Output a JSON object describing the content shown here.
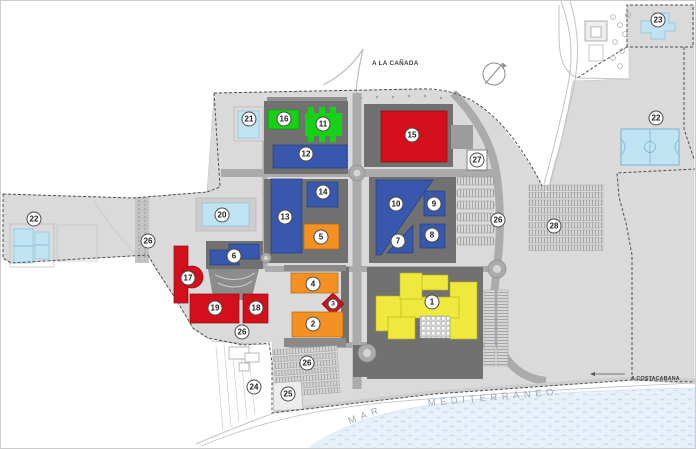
{
  "map": {
    "road_labels": {
      "north": "A LA CAÑADA",
      "east": "A COSTACABANA"
    },
    "sea_labels": {
      "word1": "MAR",
      "word2": "MEDITERRÁNEO"
    },
    "colors": {
      "red": "#d40f1c",
      "blue": "#3758ac",
      "green": "#16d116",
      "orange": "#f49122",
      "yellow": "#efe93e",
      "pool": "#bfe3f2",
      "land": "#dadada",
      "block": "#717171",
      "road": "#ababab",
      "sea": "#e8f1f9"
    },
    "markers": [
      {
        "n": "1",
        "x": 431,
        "y": 301,
        "cat": "yellow"
      },
      {
        "n": "2",
        "x": 312,
        "y": 323,
        "cat": "orange"
      },
      {
        "n": "3",
        "x": 332,
        "y": 303,
        "cat": "red",
        "small": true
      },
      {
        "n": "4",
        "x": 312,
        "y": 283,
        "cat": "orange"
      },
      {
        "n": "5",
        "x": 320,
        "y": 236,
        "cat": "orange"
      },
      {
        "n": "6",
        "x": 233,
        "y": 255,
        "cat": "blue"
      },
      {
        "n": "7",
        "x": 397,
        "y": 240,
        "cat": "blue"
      },
      {
        "n": "8",
        "x": 431,
        "y": 234,
        "cat": "blue"
      },
      {
        "n": "9",
        "x": 433,
        "y": 203,
        "cat": "blue"
      },
      {
        "n": "10",
        "x": 395,
        "y": 203,
        "cat": "blue"
      },
      {
        "n": "11",
        "x": 322,
        "y": 123,
        "cat": "green"
      },
      {
        "n": "12",
        "x": 305,
        "y": 153,
        "cat": "blue"
      },
      {
        "n": "13",
        "x": 284,
        "y": 216,
        "cat": "blue"
      },
      {
        "n": "14",
        "x": 322,
        "y": 191,
        "cat": "blue"
      },
      {
        "n": "15",
        "x": 411,
        "y": 134,
        "cat": "red"
      },
      {
        "n": "16",
        "x": 283,
        "y": 118,
        "cat": "green"
      },
      {
        "n": "17",
        "x": 187,
        "y": 277,
        "cat": "red"
      },
      {
        "n": "18",
        "x": 255,
        "y": 307,
        "cat": "red"
      },
      {
        "n": "19",
        "x": 214,
        "y": 307,
        "cat": "red"
      },
      {
        "n": "20",
        "x": 221,
        "y": 214,
        "cat": "pool"
      },
      {
        "n": "21",
        "x": 248,
        "y": 118,
        "cat": "pool"
      },
      {
        "n": "22",
        "x": 33,
        "y": 218,
        "cat": "court"
      },
      {
        "n": "22",
        "x": 655,
        "y": 117,
        "cat": "court"
      },
      {
        "n": "23",
        "x": 657,
        "y": 19,
        "cat": "pool"
      },
      {
        "n": "24",
        "x": 253,
        "y": 386,
        "cat": "area"
      },
      {
        "n": "25",
        "x": 287,
        "y": 393,
        "cat": "area"
      },
      {
        "n": "26",
        "x": 147,
        "y": 240,
        "cat": "parking"
      },
      {
        "n": "26",
        "x": 241,
        "y": 331,
        "cat": "parking"
      },
      {
        "n": "26",
        "x": 306,
        "y": 362,
        "cat": "parking"
      },
      {
        "n": "26",
        "x": 497,
        "y": 219,
        "cat": "parking"
      },
      {
        "n": "27",
        "x": 476,
        "y": 159,
        "cat": "facility"
      },
      {
        "n": "28",
        "x": 553,
        "y": 225,
        "cat": "parking"
      }
    ]
  }
}
